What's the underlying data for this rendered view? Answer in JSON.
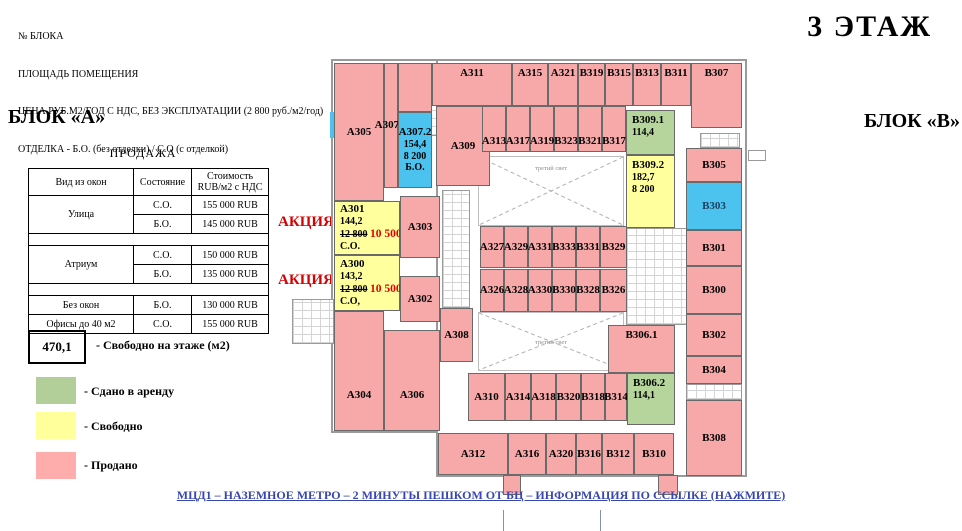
{
  "header": {
    "lines": [
      "№ БЛОКА",
      "ПЛОЩАДЬ ПОМЕЩЕНИЯ",
      "ЦЕНА РУБ.М2/ГОД С НДС, БЕЗ ЭКСПЛУАТАЦИИ (2 800 руб./м2/год)",
      "ОТДЕЛКА - Б.О. (без отделки) / С.О (с отделкой)"
    ],
    "floor_title": "3 ЭТАЖ"
  },
  "block_a_label": "БЛОК «А»",
  "block_b_label": "БЛОК «В»",
  "sales_table": {
    "title": "ПРОДАЖА",
    "columns": [
      "Вид из окон",
      "Состояние"
    ],
    "price_header": [
      "Стоимость",
      "RUB/м2 с НДС"
    ],
    "groups": [
      {
        "view": "Улица",
        "rows": [
          [
            "С.О.",
            "155 000 RUB"
          ],
          [
            "Б.О.",
            "145 000 RUB"
          ]
        ]
      },
      {
        "view": "Атриум",
        "rows": [
          [
            "С.О.",
            "150 000 RUB"
          ],
          [
            "Б.О.",
            "135 000 RUB"
          ]
        ]
      },
      {
        "view": "Без окон",
        "rows": [
          [
            "Б.О.",
            "130 000 RUB"
          ]
        ]
      },
      {
        "view": "Офисы до 40 м2",
        "rows": [
          [
            "С.О.",
            "155 000 RUB"
          ]
        ]
      }
    ]
  },
  "legend": {
    "free_area_value": "470,1",
    "free_area_label": "- Свободно на этаже (м2)",
    "items": [
      {
        "color": "#b2cf9a",
        "label": "- Сдано в аренду"
      },
      {
        "color": "#ffff9b",
        "label": "- Свободно"
      },
      {
        "color": "#ffacac",
        "label": "- Продано"
      }
    ]
  },
  "promo": {
    "label": "АКЦИЯ!"
  },
  "footer": {
    "link_text": "МЦД1 – НАЗЕМНОЕ МЕТРО – 2 МИНУТЫ ПЕШКОМ ОТ БЦ – ИНФОРМАЦИЯ ПО ССЫЛКЕ (НАЖМИТЕ)"
  },
  "floor_plan": {
    "atrium_label": "третий свет",
    "colors": {
      "sold": "#f7a8a8",
      "free": "#ffff9d",
      "leased": "#b5d59c",
      "special": "#4cc3ee"
    },
    "atria": [
      {
        "x": 478,
        "y": 156,
        "w": 146,
        "h": 70,
        "label_pos": "top"
      },
      {
        "x": 478,
        "y": 312,
        "w": 146,
        "h": 59,
        "label_pos": "middle"
      }
    ],
    "cores": [
      {
        "x": 430,
        "y": 86,
        "w": 34,
        "h": 50
      },
      {
        "x": 442,
        "y": 190,
        "w": 28,
        "h": 118
      },
      {
        "x": 626,
        "y": 228,
        "w": 66,
        "h": 97
      },
      {
        "x": 686,
        "y": 384,
        "w": 56,
        "h": 16
      },
      {
        "x": 700,
        "y": 133,
        "w": 40,
        "h": 15
      },
      {
        "x": 292,
        "y": 299,
        "w": 42,
        "h": 45
      }
    ],
    "rooms": [
      {
        "id": "А305",
        "st": "sold",
        "x": 334,
        "y": 63,
        "w": 50,
        "h": 138
      },
      {
        "id": "А307.1",
        "st": "sold",
        "x": 384,
        "y": 63,
        "w": 14,
        "h": 125
      },
      {
        "id": "",
        "st": "sold",
        "x": 398,
        "y": 63,
        "w": 34,
        "h": 49
      },
      {
        "id": "А307.2",
        "st": "special",
        "x": 398,
        "y": 112,
        "w": 34,
        "h": 76,
        "lines": [
          "154,4",
          "8 200",
          "Б.О."
        ]
      },
      {
        "id": "А311",
        "st": "sold",
        "x": 432,
        "y": 63,
        "w": 80,
        "h": 43,
        "va": "top"
      },
      {
        "id": "А315",
        "st": "sold",
        "x": 512,
        "y": 63,
        "w": 36,
        "h": 43,
        "va": "top"
      },
      {
        "id": "А321",
        "st": "sold",
        "x": 548,
        "y": 63,
        "w": 30,
        "h": 43,
        "va": "top"
      },
      {
        "id": "В319",
        "st": "sold",
        "x": 578,
        "y": 63,
        "w": 27,
        "h": 43,
        "va": "top"
      },
      {
        "id": "В315",
        "st": "sold",
        "x": 605,
        "y": 63,
        "w": 28,
        "h": 43,
        "va": "top"
      },
      {
        "id": "В313",
        "st": "sold",
        "x": 633,
        "y": 63,
        "w": 28,
        "h": 43,
        "va": "top"
      },
      {
        "id": "В311",
        "st": "sold",
        "x": 661,
        "y": 63,
        "w": 30,
        "h": 43,
        "va": "top"
      },
      {
        "id": "В307",
        "st": "sold",
        "x": 691,
        "y": 63,
        "w": 51,
        "h": 65,
        "va": "top"
      },
      {
        "id": "А309",
        "st": "sold",
        "x": 436,
        "y": 106,
        "w": 54,
        "h": 80
      },
      {
        "id": "А313",
        "st": "sold",
        "x": 482,
        "y": 106,
        "w": 24,
        "h": 46,
        "va": "bottom"
      },
      {
        "id": "А317",
        "st": "sold",
        "x": 506,
        "y": 106,
        "w": 24,
        "h": 46,
        "va": "bottom"
      },
      {
        "id": "А319",
        "st": "sold",
        "x": 530,
        "y": 106,
        "w": 24,
        "h": 46,
        "va": "bottom"
      },
      {
        "id": "В323",
        "st": "sold",
        "x": 554,
        "y": 106,
        "w": 24,
        "h": 46,
        "va": "bottom"
      },
      {
        "id": "В321",
        "st": "sold",
        "x": 578,
        "y": 106,
        "w": 24,
        "h": 46,
        "va": "bottom"
      },
      {
        "id": "В317",
        "st": "sold",
        "x": 602,
        "y": 106,
        "w": 24,
        "h": 46,
        "va": "bottom"
      },
      {
        "id": "В309.1",
        "st": "leased",
        "x": 626,
        "y": 110,
        "w": 49,
        "h": 45,
        "lines": [
          "114,4"
        ],
        "al": "left",
        "va": "top"
      },
      {
        "id": "В309.2",
        "st": "free",
        "x": 626,
        "y": 155,
        "w": 49,
        "h": 73,
        "lines": [
          "182,7",
          "8 200"
        ],
        "al": "left",
        "va": "top"
      },
      {
        "id": "А301",
        "st": "free",
        "x": 334,
        "y": 201,
        "w": 66,
        "h": 54,
        "lines": [
          "144,2",
          {
            "s": "12 800",
            "p": "10 500"
          },
          "С.О."
        ],
        "al": "left"
      },
      {
        "id": "А300",
        "st": "free",
        "x": 334,
        "y": 255,
        "w": 66,
        "h": 56,
        "lines": [
          "143,2",
          {
            "s": "12 800",
            "p": "10 500"
          },
          "С.О,"
        ],
        "al": "left"
      },
      {
        "id": "А303",
        "st": "sold",
        "x": 400,
        "y": 196,
        "w": 40,
        "h": 62
      },
      {
        "id": "А302",
        "st": "sold",
        "x": 400,
        "y": 276,
        "w": 40,
        "h": 46
      },
      {
        "id": "А304",
        "st": "sold",
        "x": 334,
        "y": 311,
        "w": 50,
        "h": 120,
        "va": "low"
      },
      {
        "id": "А306",
        "st": "sold",
        "x": 384,
        "y": 330,
        "w": 56,
        "h": 101,
        "va": "low"
      },
      {
        "id": "А308",
        "st": "sold",
        "x": 440,
        "y": 308,
        "w": 33,
        "h": 54
      },
      {
        "id": "А327",
        "st": "sold",
        "x": 480,
        "y": 226,
        "w": 24,
        "h": 42
      },
      {
        "id": "А329",
        "st": "sold",
        "x": 504,
        "y": 226,
        "w": 24,
        "h": 42
      },
      {
        "id": "А331",
        "st": "sold",
        "x": 528,
        "y": 226,
        "w": 24,
        "h": 42
      },
      {
        "id": "В333",
        "st": "sold",
        "x": 552,
        "y": 226,
        "w": 24,
        "h": 42
      },
      {
        "id": "В331",
        "st": "sold",
        "x": 576,
        "y": 226,
        "w": 24,
        "h": 42
      },
      {
        "id": "В329",
        "st": "sold",
        "x": 600,
        "y": 226,
        "w": 27,
        "h": 42
      },
      {
        "id": "А326",
        "st": "sold",
        "x": 480,
        "y": 269,
        "w": 24,
        "h": 43
      },
      {
        "id": "А328",
        "st": "sold",
        "x": 504,
        "y": 269,
        "w": 24,
        "h": 43
      },
      {
        "id": "А330",
        "st": "sold",
        "x": 528,
        "y": 269,
        "w": 24,
        "h": 43
      },
      {
        "id": "В330",
        "st": "sold",
        "x": 552,
        "y": 269,
        "w": 24,
        "h": 43
      },
      {
        "id": "В328",
        "st": "sold",
        "x": 576,
        "y": 269,
        "w": 24,
        "h": 43
      },
      {
        "id": "В326",
        "st": "sold",
        "x": 600,
        "y": 269,
        "w": 27,
        "h": 43
      },
      {
        "id": "А310",
        "st": "sold",
        "x": 468,
        "y": 373,
        "w": 37,
        "h": 48
      },
      {
        "id": "А314",
        "st": "sold",
        "x": 505,
        "y": 373,
        "w": 26,
        "h": 48
      },
      {
        "id": "А318",
        "st": "sold",
        "x": 531,
        "y": 373,
        "w": 25,
        "h": 48
      },
      {
        "id": "В320",
        "st": "sold",
        "x": 556,
        "y": 373,
        "w": 25,
        "h": 48
      },
      {
        "id": "В318",
        "st": "sold",
        "x": 581,
        "y": 373,
        "w": 24,
        "h": 48
      },
      {
        "id": "В314",
        "st": "sold",
        "x": 605,
        "y": 373,
        "w": 22,
        "h": 48
      },
      {
        "id": "В306.2",
        "st": "leased",
        "x": 627,
        "y": 373,
        "w": 48,
        "h": 52,
        "lines": [
          "114,1"
        ],
        "al": "left",
        "va": "top"
      },
      {
        "id": "В306.1",
        "st": "sold",
        "x": 608,
        "y": 325,
        "w": 67,
        "h": 48,
        "va": "top"
      },
      {
        "id": "А312",
        "st": "sold",
        "x": 438,
        "y": 433,
        "w": 70,
        "h": 42
      },
      {
        "id": "А316",
        "st": "sold",
        "x": 508,
        "y": 433,
        "w": 38,
        "h": 42
      },
      {
        "id": "А320",
        "st": "sold",
        "x": 546,
        "y": 433,
        "w": 30,
        "h": 42
      },
      {
        "id": "В316",
        "st": "sold",
        "x": 576,
        "y": 433,
        "w": 26,
        "h": 42
      },
      {
        "id": "В312",
        "st": "sold",
        "x": 602,
        "y": 433,
        "w": 32,
        "h": 42
      },
      {
        "id": "В310",
        "st": "sold",
        "x": 634,
        "y": 433,
        "w": 40,
        "h": 42
      },
      {
        "id": "В308",
        "st": "sold",
        "x": 686,
        "y": 400,
        "w": 56,
        "h": 76
      },
      {
        "id": "В305",
        "st": "sold",
        "x": 686,
        "y": 148,
        "w": 56,
        "h": 34
      },
      {
        "id": "В303",
        "st": "special",
        "x": 686,
        "y": 182,
        "w": 56,
        "h": 48,
        "label_color": "#1e3e5f"
      },
      {
        "id": "В301",
        "st": "sold",
        "x": 686,
        "y": 230,
        "w": 56,
        "h": 36
      },
      {
        "id": "В300",
        "st": "sold",
        "x": 686,
        "y": 266,
        "w": 56,
        "h": 48
      },
      {
        "id": "В302",
        "st": "sold",
        "x": 686,
        "y": 314,
        "w": 56,
        "h": 42
      },
      {
        "id": "В304",
        "st": "sold",
        "x": 686,
        "y": 356,
        "w": 56,
        "h": 28
      },
      {
        "id": "",
        "st": "sold",
        "x": 503,
        "y": 475,
        "w": 18,
        "h": 20
      },
      {
        "id": "",
        "st": "sold",
        "x": 658,
        "y": 475,
        "w": 20,
        "h": 20
      }
    ]
  }
}
